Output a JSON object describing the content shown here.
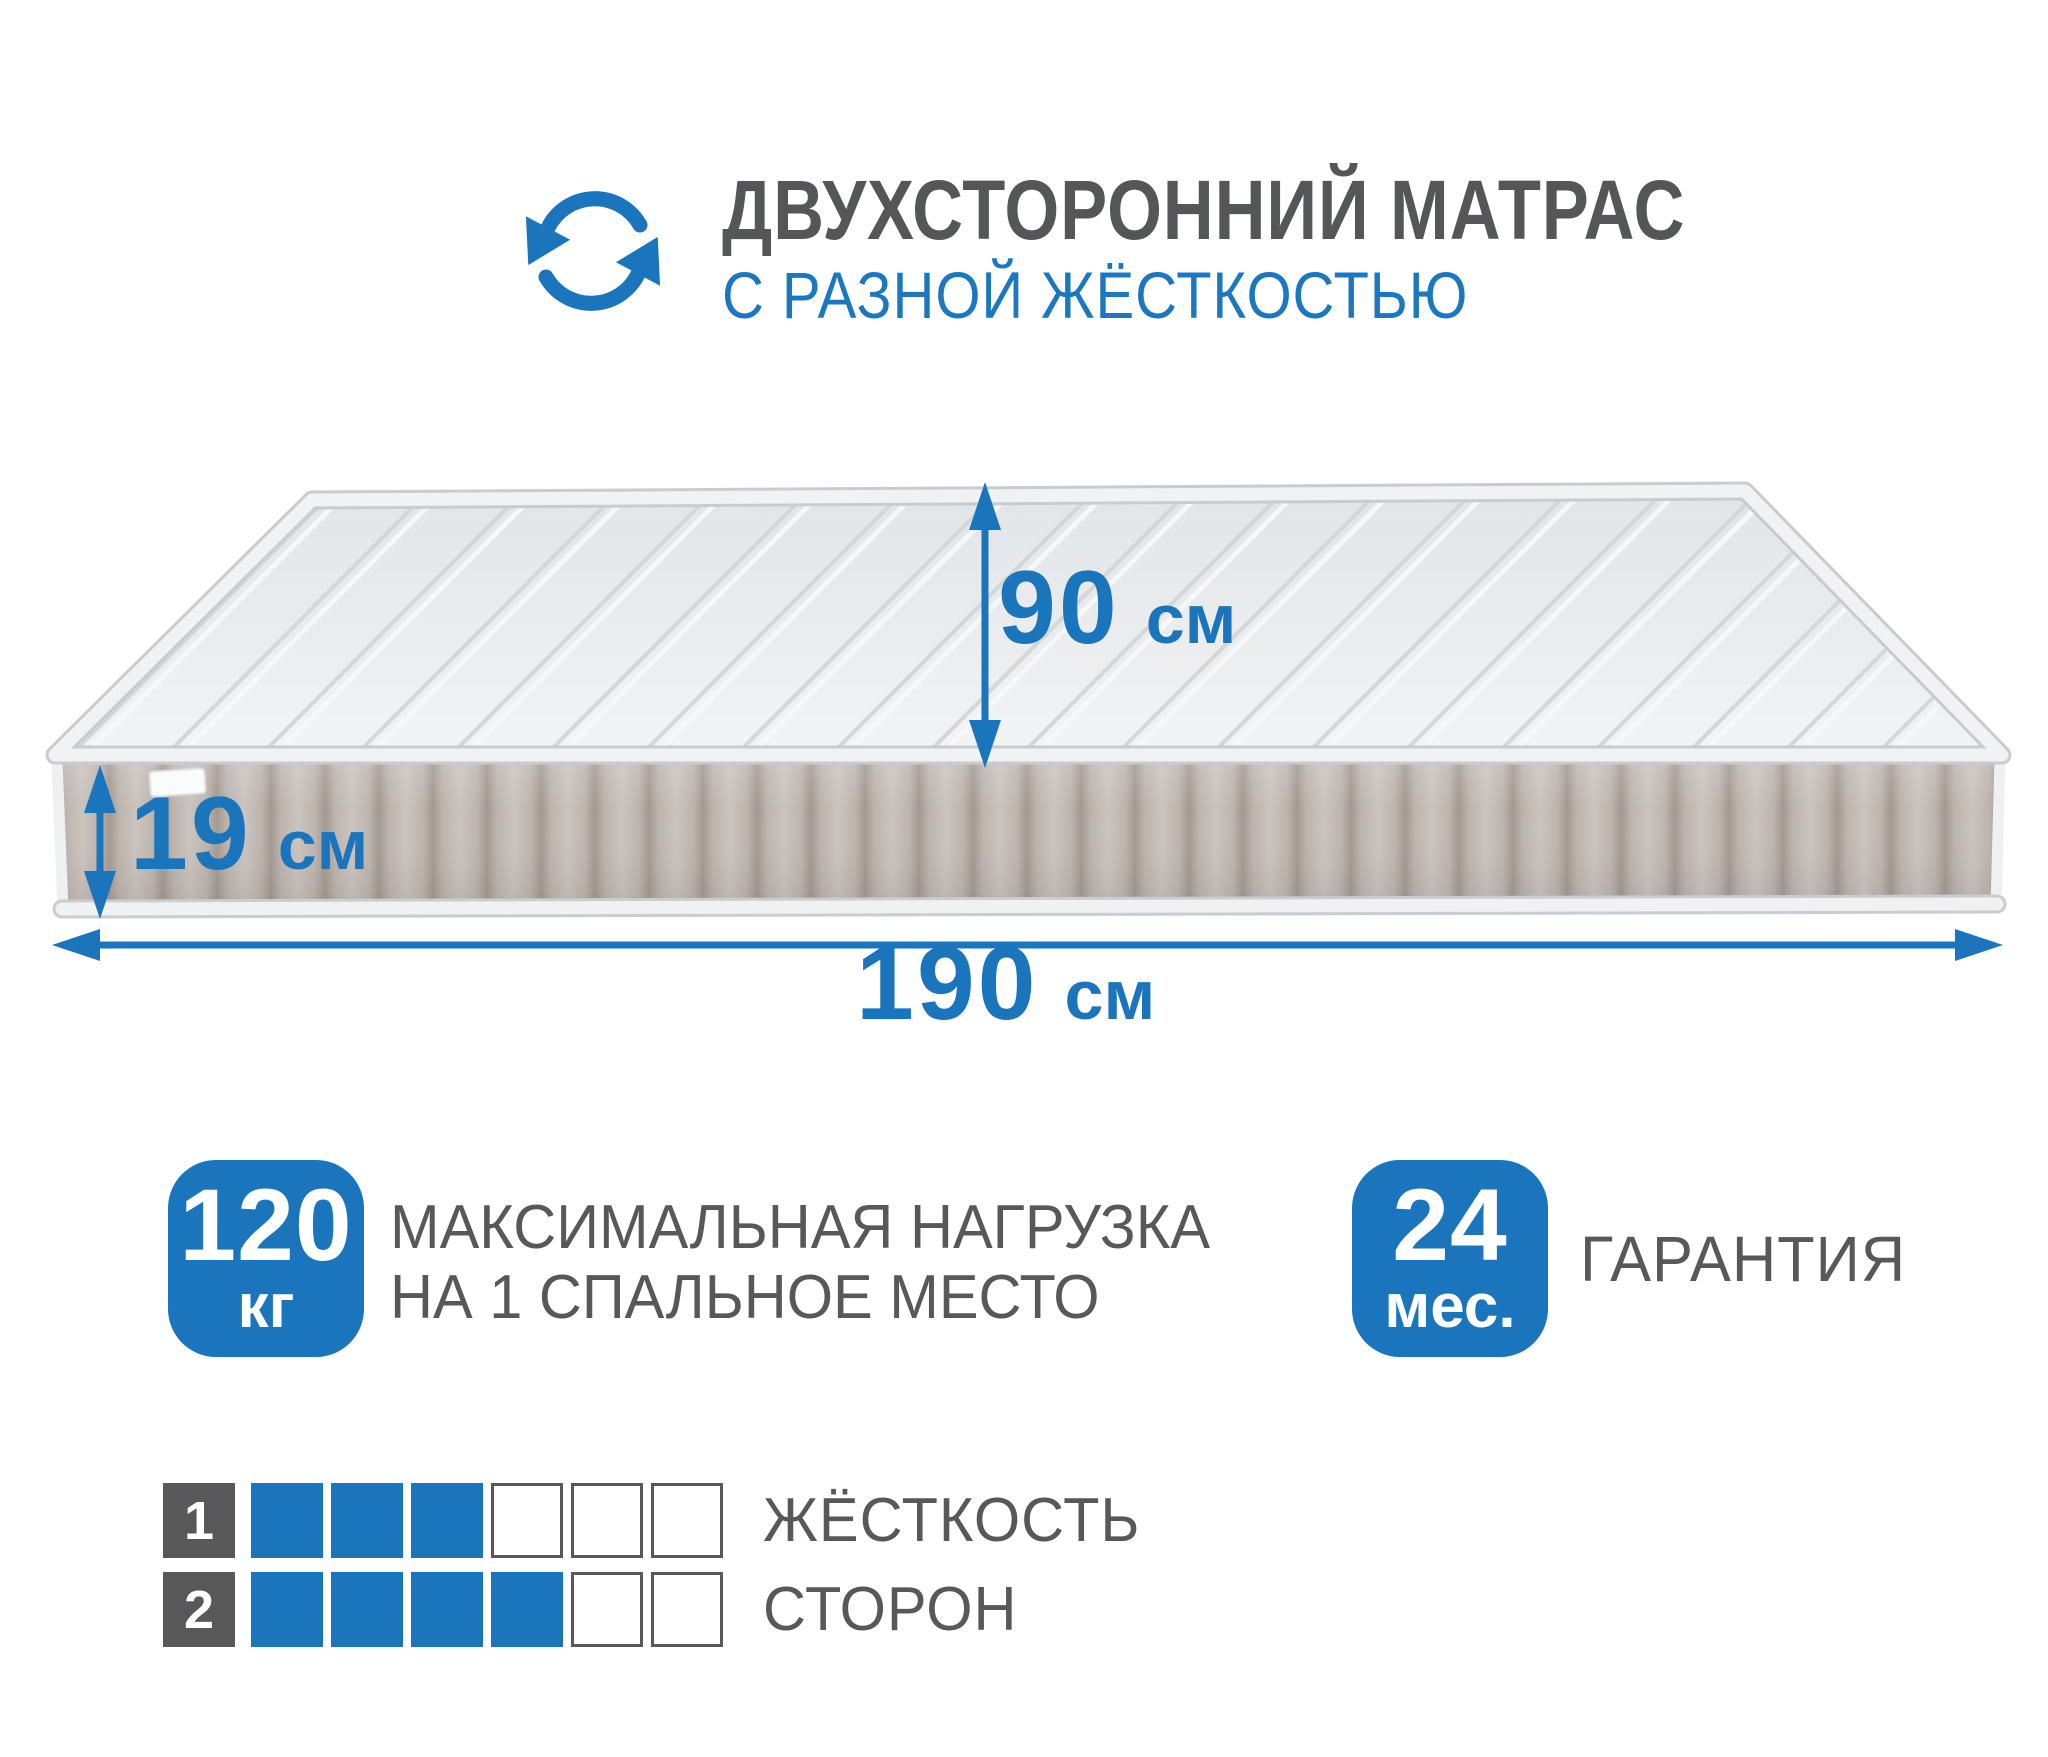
{
  "colors": {
    "accent": "#1b75bc",
    "text_gray": "#58585a"
  },
  "header": {
    "icon": "rotate-arrows-icon",
    "title": "ДВУХСТОРОННИЙ МАТРАС",
    "subtitle": "С РАЗНОЙ ЖЁСТКОСТЬЮ"
  },
  "mattress": {
    "width_label": {
      "value": "90",
      "unit": "см"
    },
    "height_label": {
      "value": "19",
      "unit": "см"
    },
    "length_label": {
      "value": "190",
      "unit": "см"
    }
  },
  "badges": {
    "max_load": {
      "value": "120",
      "unit": "кг",
      "description_line1": "МАКСИМАЛЬНАЯ НАГРУЗКА",
      "description_line2": "НА 1 СПАЛЬНОЕ МЕСТО"
    },
    "warranty": {
      "value": "24",
      "unit": "мес.",
      "description": "ГАРАНТИЯ"
    }
  },
  "firmness": {
    "title_line1": "ЖЁСТКОСТЬ",
    "title_line2": "СТОРОН",
    "scale_max": 6,
    "rows": [
      {
        "side": "1",
        "filled": 3
      },
      {
        "side": "2",
        "filled": 4
      }
    ]
  }
}
